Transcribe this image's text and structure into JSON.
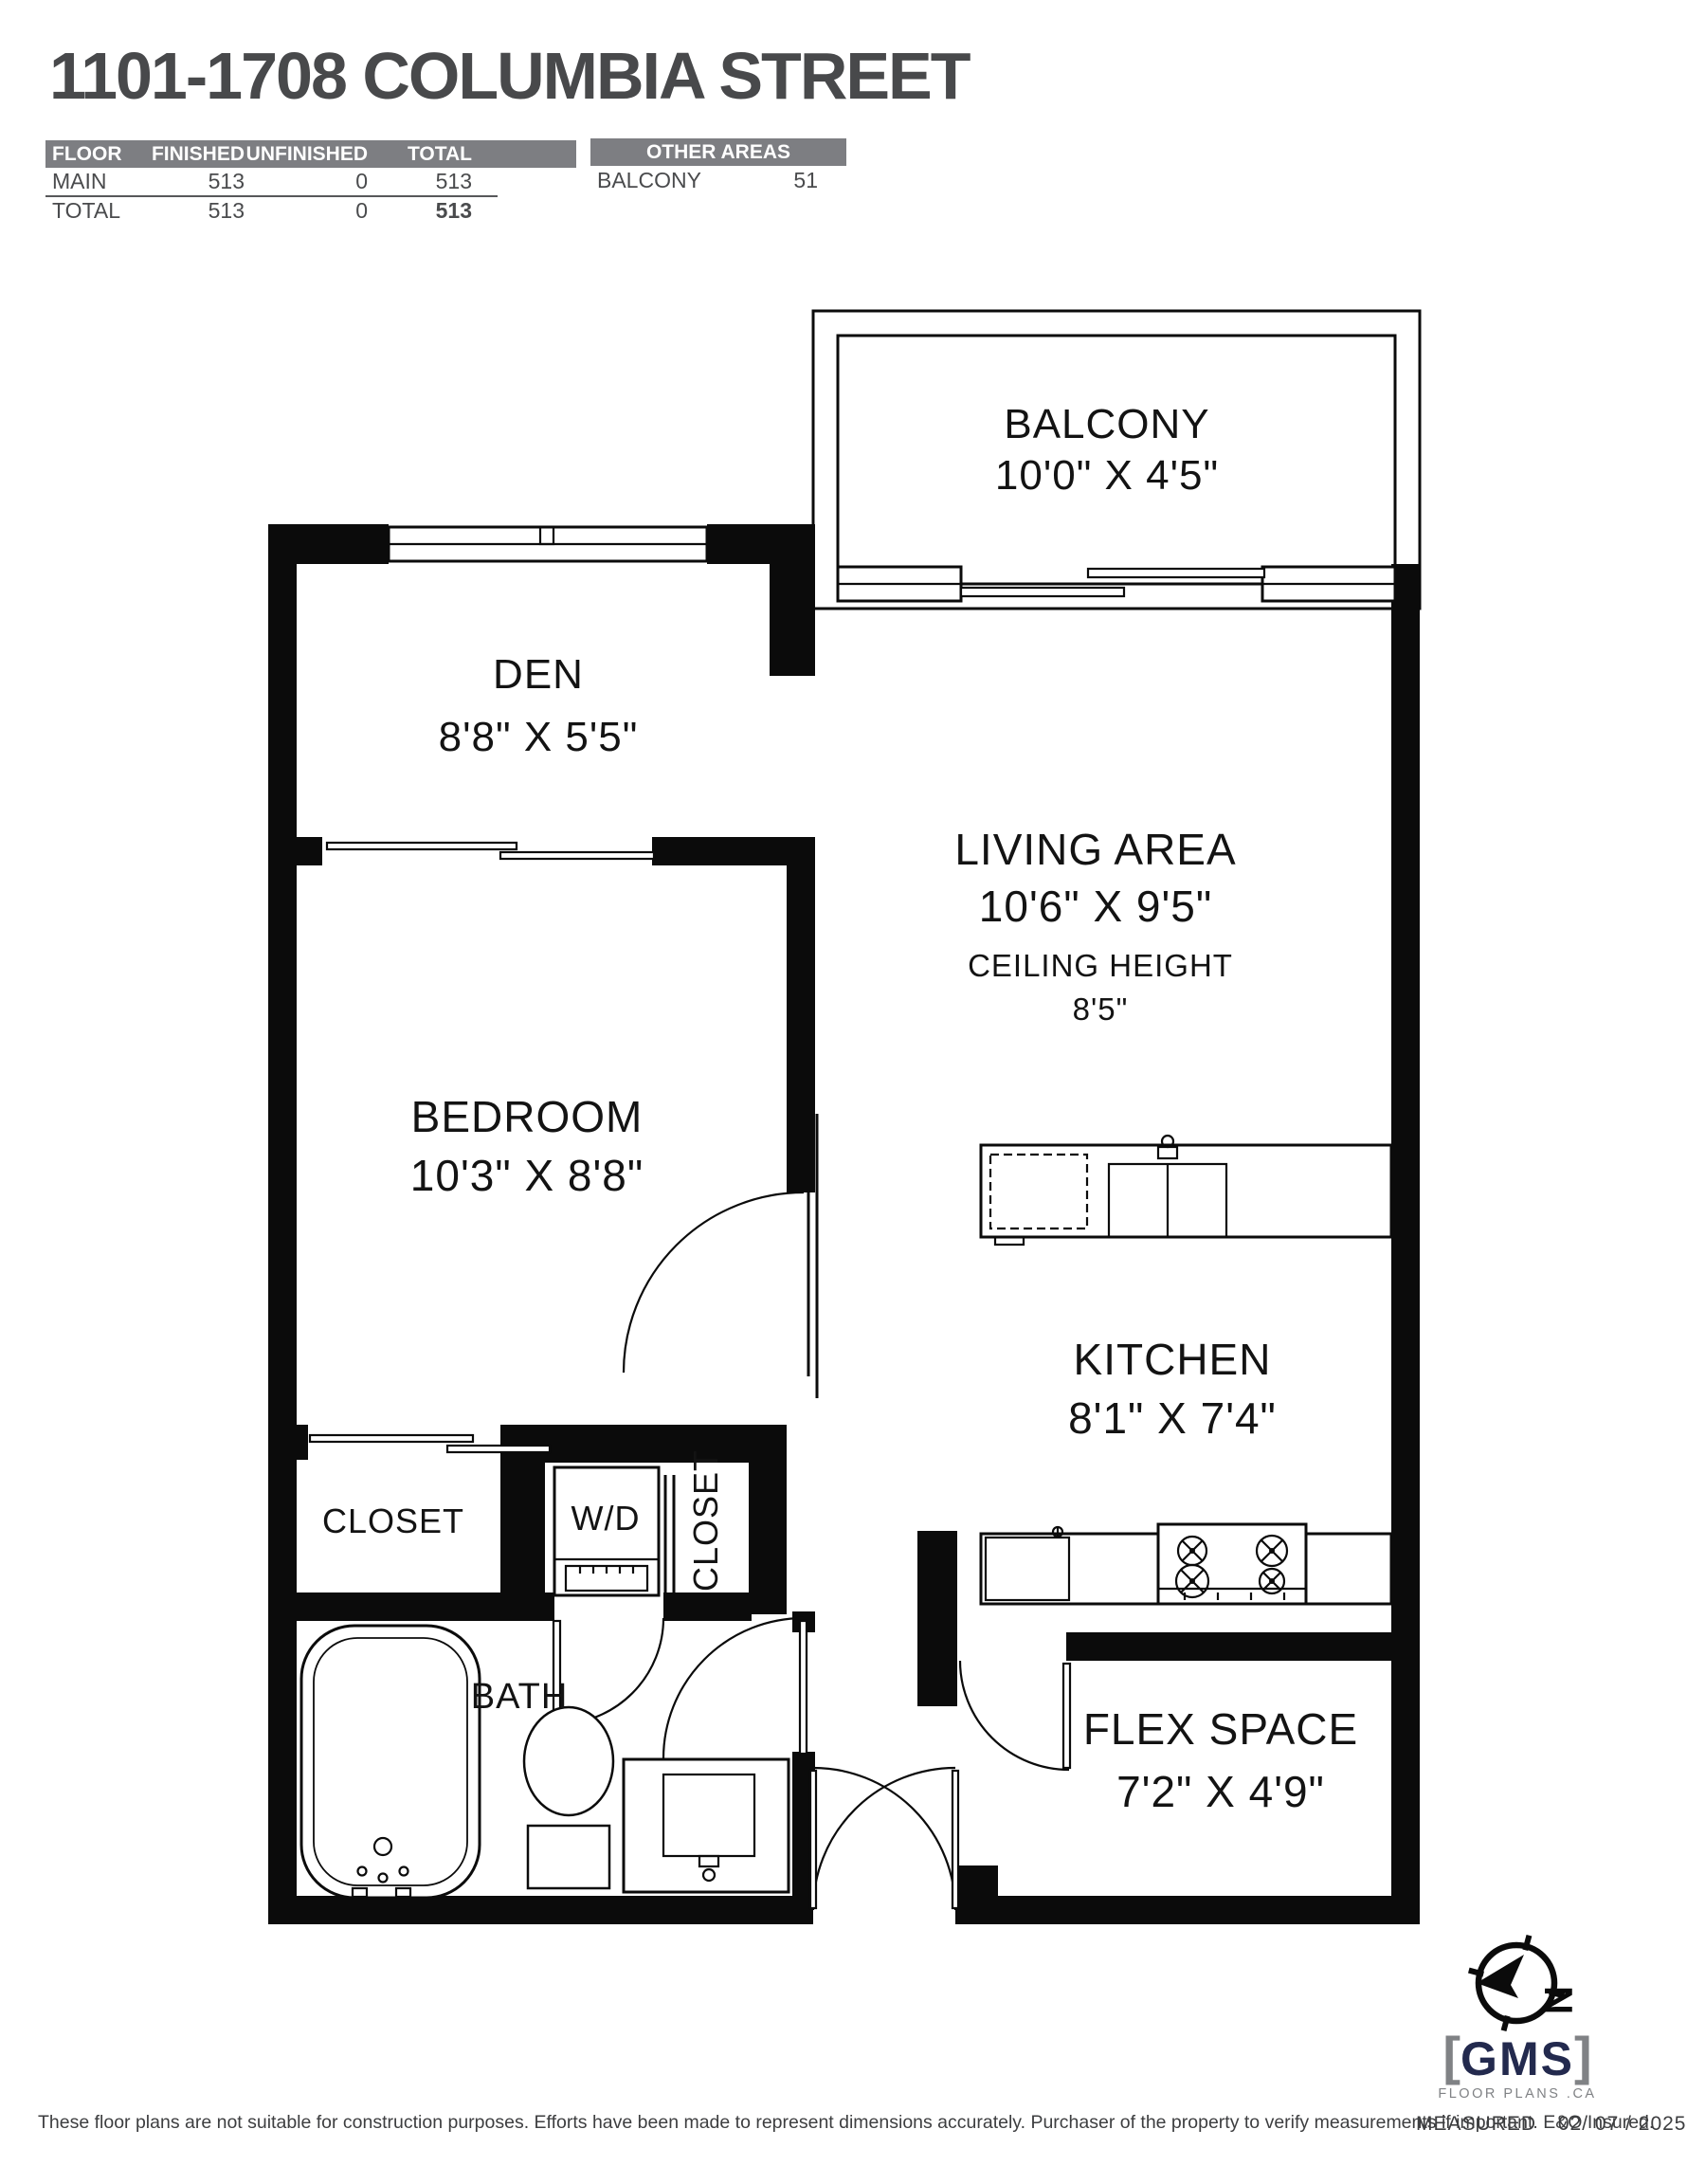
{
  "title": "1101-1708 COLUMBIA STREET",
  "area_table": {
    "headers": [
      "FLOOR",
      "FINISHED",
      "UNFINISHED",
      "TOTAL"
    ],
    "rows": [
      {
        "floor": "MAIN",
        "finished": "513",
        "unfinished": "0",
        "total": "513"
      },
      {
        "floor": "TOTAL",
        "finished": "513",
        "unfinished": "0",
        "total": "513"
      }
    ]
  },
  "other_areas": {
    "header": "OTHER AREAS",
    "rows": [
      {
        "name": "BALCONY",
        "value": "51"
      }
    ]
  },
  "rooms": {
    "balcony": {
      "name": "BALCONY",
      "dims": "10'0\" X 4'5\""
    },
    "den": {
      "name": "DEN",
      "dims": "8'8\" X 5'5\""
    },
    "living": {
      "name": "LIVING AREA",
      "dims": "10'6\" X 9'5\"",
      "ceiling_label": "CEILING HEIGHT",
      "ceiling": "8'5\""
    },
    "bedroom": {
      "name": "BEDROOM",
      "dims": "10'3\" X 8'8\""
    },
    "kitchen": {
      "name": "KITCHEN",
      "dims": "8'1\" X 7'4\""
    },
    "closet1": {
      "name": "CLOSET"
    },
    "wd": {
      "name": "W/D"
    },
    "closet2": {
      "name": "CLOSET"
    },
    "bath": {
      "name": "BATH"
    },
    "flex": {
      "name": "FLEX SPACE",
      "dims": "7'2\" X 4'9\""
    }
  },
  "footer": {
    "disclaimer": "These floor plans are not suitable for construction purposes. Efforts have been made to represent dimensions accurately.  Purchaser of the property to verify measurements if important.  E&O Insured.",
    "measured_label": "MEASURED",
    "measured_date": "02/ 07 / 2025"
  },
  "logo": {
    "bracket_left": "[",
    "name": "GMS",
    "bracket_right": "]",
    "tagline": "FLOOR PLANS .CA",
    "navy": "#232a4e",
    "gray": "#808285"
  }
}
